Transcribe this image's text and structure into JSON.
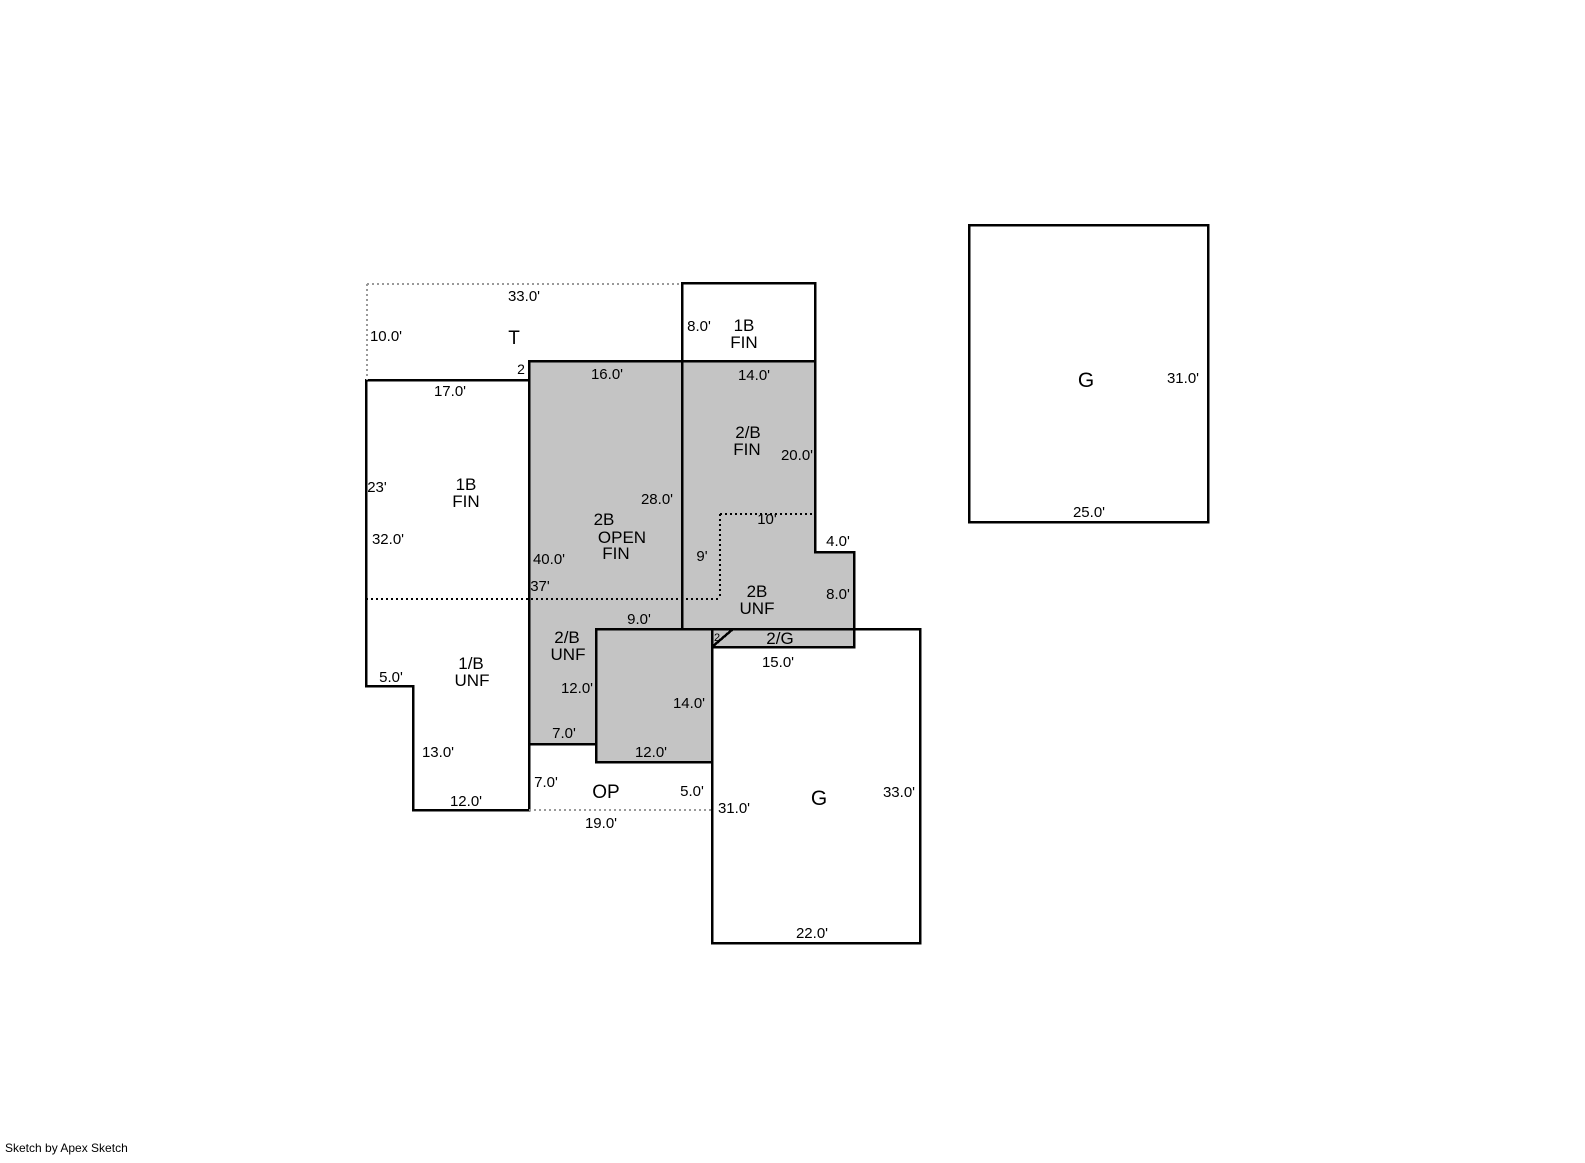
{
  "watermark": "Sketch by Apex Sketch",
  "colors": {
    "area_fill": "#c4c4c4",
    "outline": "#000000",
    "dotted_line": "#999999",
    "background": "#ffffff"
  },
  "regions": {
    "t": {
      "label": "T",
      "width": "33.0'",
      "height": "10.0'",
      "step": "2"
    },
    "fin_1b_top": {
      "label_lines": [
        "1B",
        "FIN"
      ],
      "height": "8.0'"
    },
    "fin_2b": {
      "label_lines": [
        "2/B",
        "FIN"
      ],
      "width": "14.0'",
      "height": "20.0'"
    },
    "open_2b": {
      "label_lines": [
        "2B",
        "OPEN",
        "FIN"
      ],
      "width": "16.0'",
      "height": "28.0'",
      "left_height": "40.0'",
      "dotted_width": "37'"
    },
    "fin_1b_left": {
      "label_lines": [
        "1B",
        "FIN"
      ],
      "width": "17.0'",
      "height_upper": "23'",
      "height_total": "32.0'"
    },
    "unf_2b_right": {
      "label_lines": [
        "2B",
        "UNF"
      ],
      "dotted_width": "10'",
      "dotted_height": "9'",
      "step": "4.0'",
      "height": "8.0'"
    },
    "two_g": {
      "label": "2/G",
      "story": "2"
    },
    "unf_2b_left": {
      "label_lines": [
        "2/B",
        "UNF"
      ],
      "height": "12.0'",
      "width": "7.0'"
    },
    "unf_2b_lower": {
      "top_width": "9.0'",
      "height": "14.0'",
      "width": "12.0'"
    },
    "unf_1b": {
      "label_lines": [
        "1/B",
        "UNF"
      ],
      "step": "5.0'",
      "height": "13.0'",
      "width": "12.0'"
    },
    "op": {
      "label": "OP",
      "left_height": "7.0'",
      "right_height": "5.0'",
      "width": "19.0'"
    },
    "g_attached": {
      "label": "G",
      "top_width": "15.0'",
      "left_height": "31.0'",
      "right_height": "33.0'",
      "bottom_width": "22.0'"
    },
    "g_detached": {
      "label": "G",
      "height": "31.0'",
      "width": "25.0'"
    }
  }
}
